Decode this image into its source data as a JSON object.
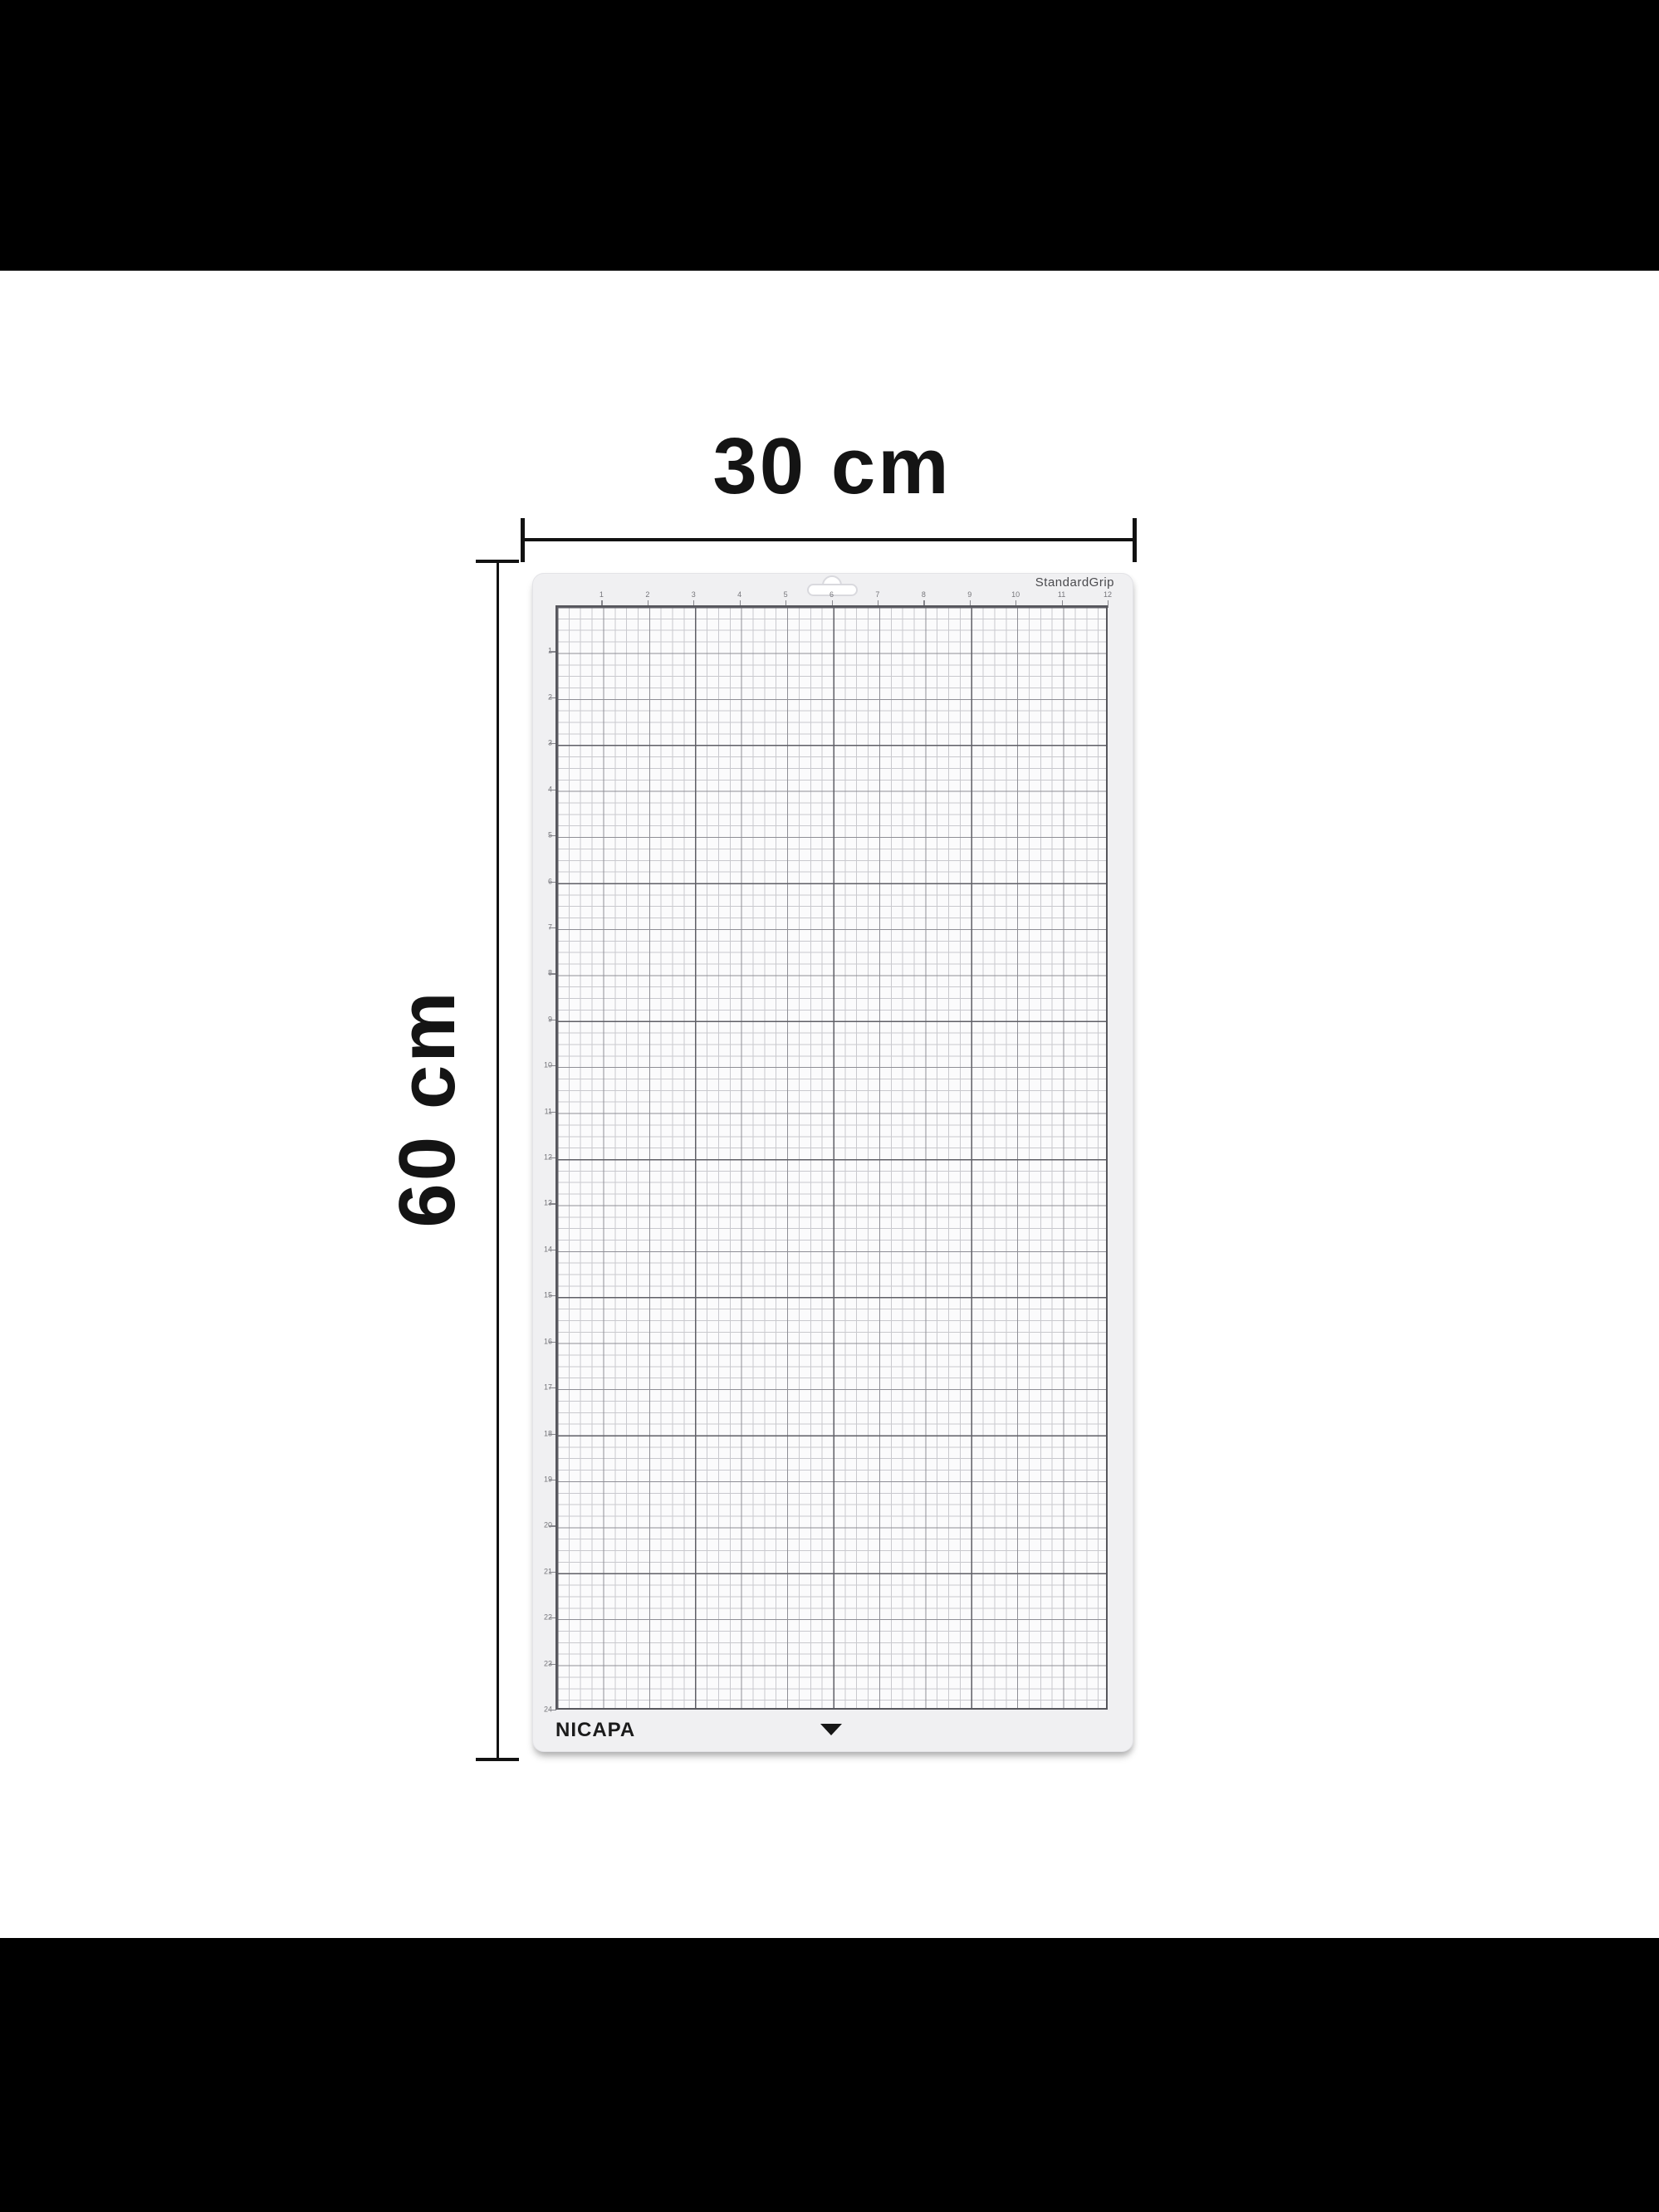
{
  "scene": {
    "background_color": "#ffffff",
    "letterbox_color": "#000000",
    "ink_color": "#121212"
  },
  "annotations": {
    "width_label": "30 cm",
    "height_label": "60 cm"
  },
  "mat": {
    "brand": "NICAPA",
    "grip_label": "StandardGrip",
    "ruler_top": [
      1,
      2,
      3,
      4,
      5,
      6,
      7,
      8,
      9,
      10,
      11,
      12
    ],
    "ruler_left": [
      1,
      2,
      3,
      4,
      5,
      6,
      7,
      8,
      9,
      10,
      11,
      12,
      13,
      14,
      15,
      16,
      17,
      18,
      19,
      20,
      21,
      22,
      23,
      24
    ],
    "grid": {
      "columns_inches": 12,
      "rows_inches": 24,
      "subdivisions_per_inch": 4
    },
    "colors": {
      "mat_body": "#f0f0f2",
      "grid_bg": "#fbfbfc",
      "line_fine": "#c9c9ce",
      "line_inch": "#8f8f96",
      "line_3inch": "#5f5f66",
      "grid_border": "#56565c",
      "label_gray": "#4a4a4e",
      "number_gray": "#76767b"
    }
  },
  "icons": {
    "alignment_triangle": "triangle-down-icon",
    "hanging_hole": "hanger-slot-icon"
  }
}
